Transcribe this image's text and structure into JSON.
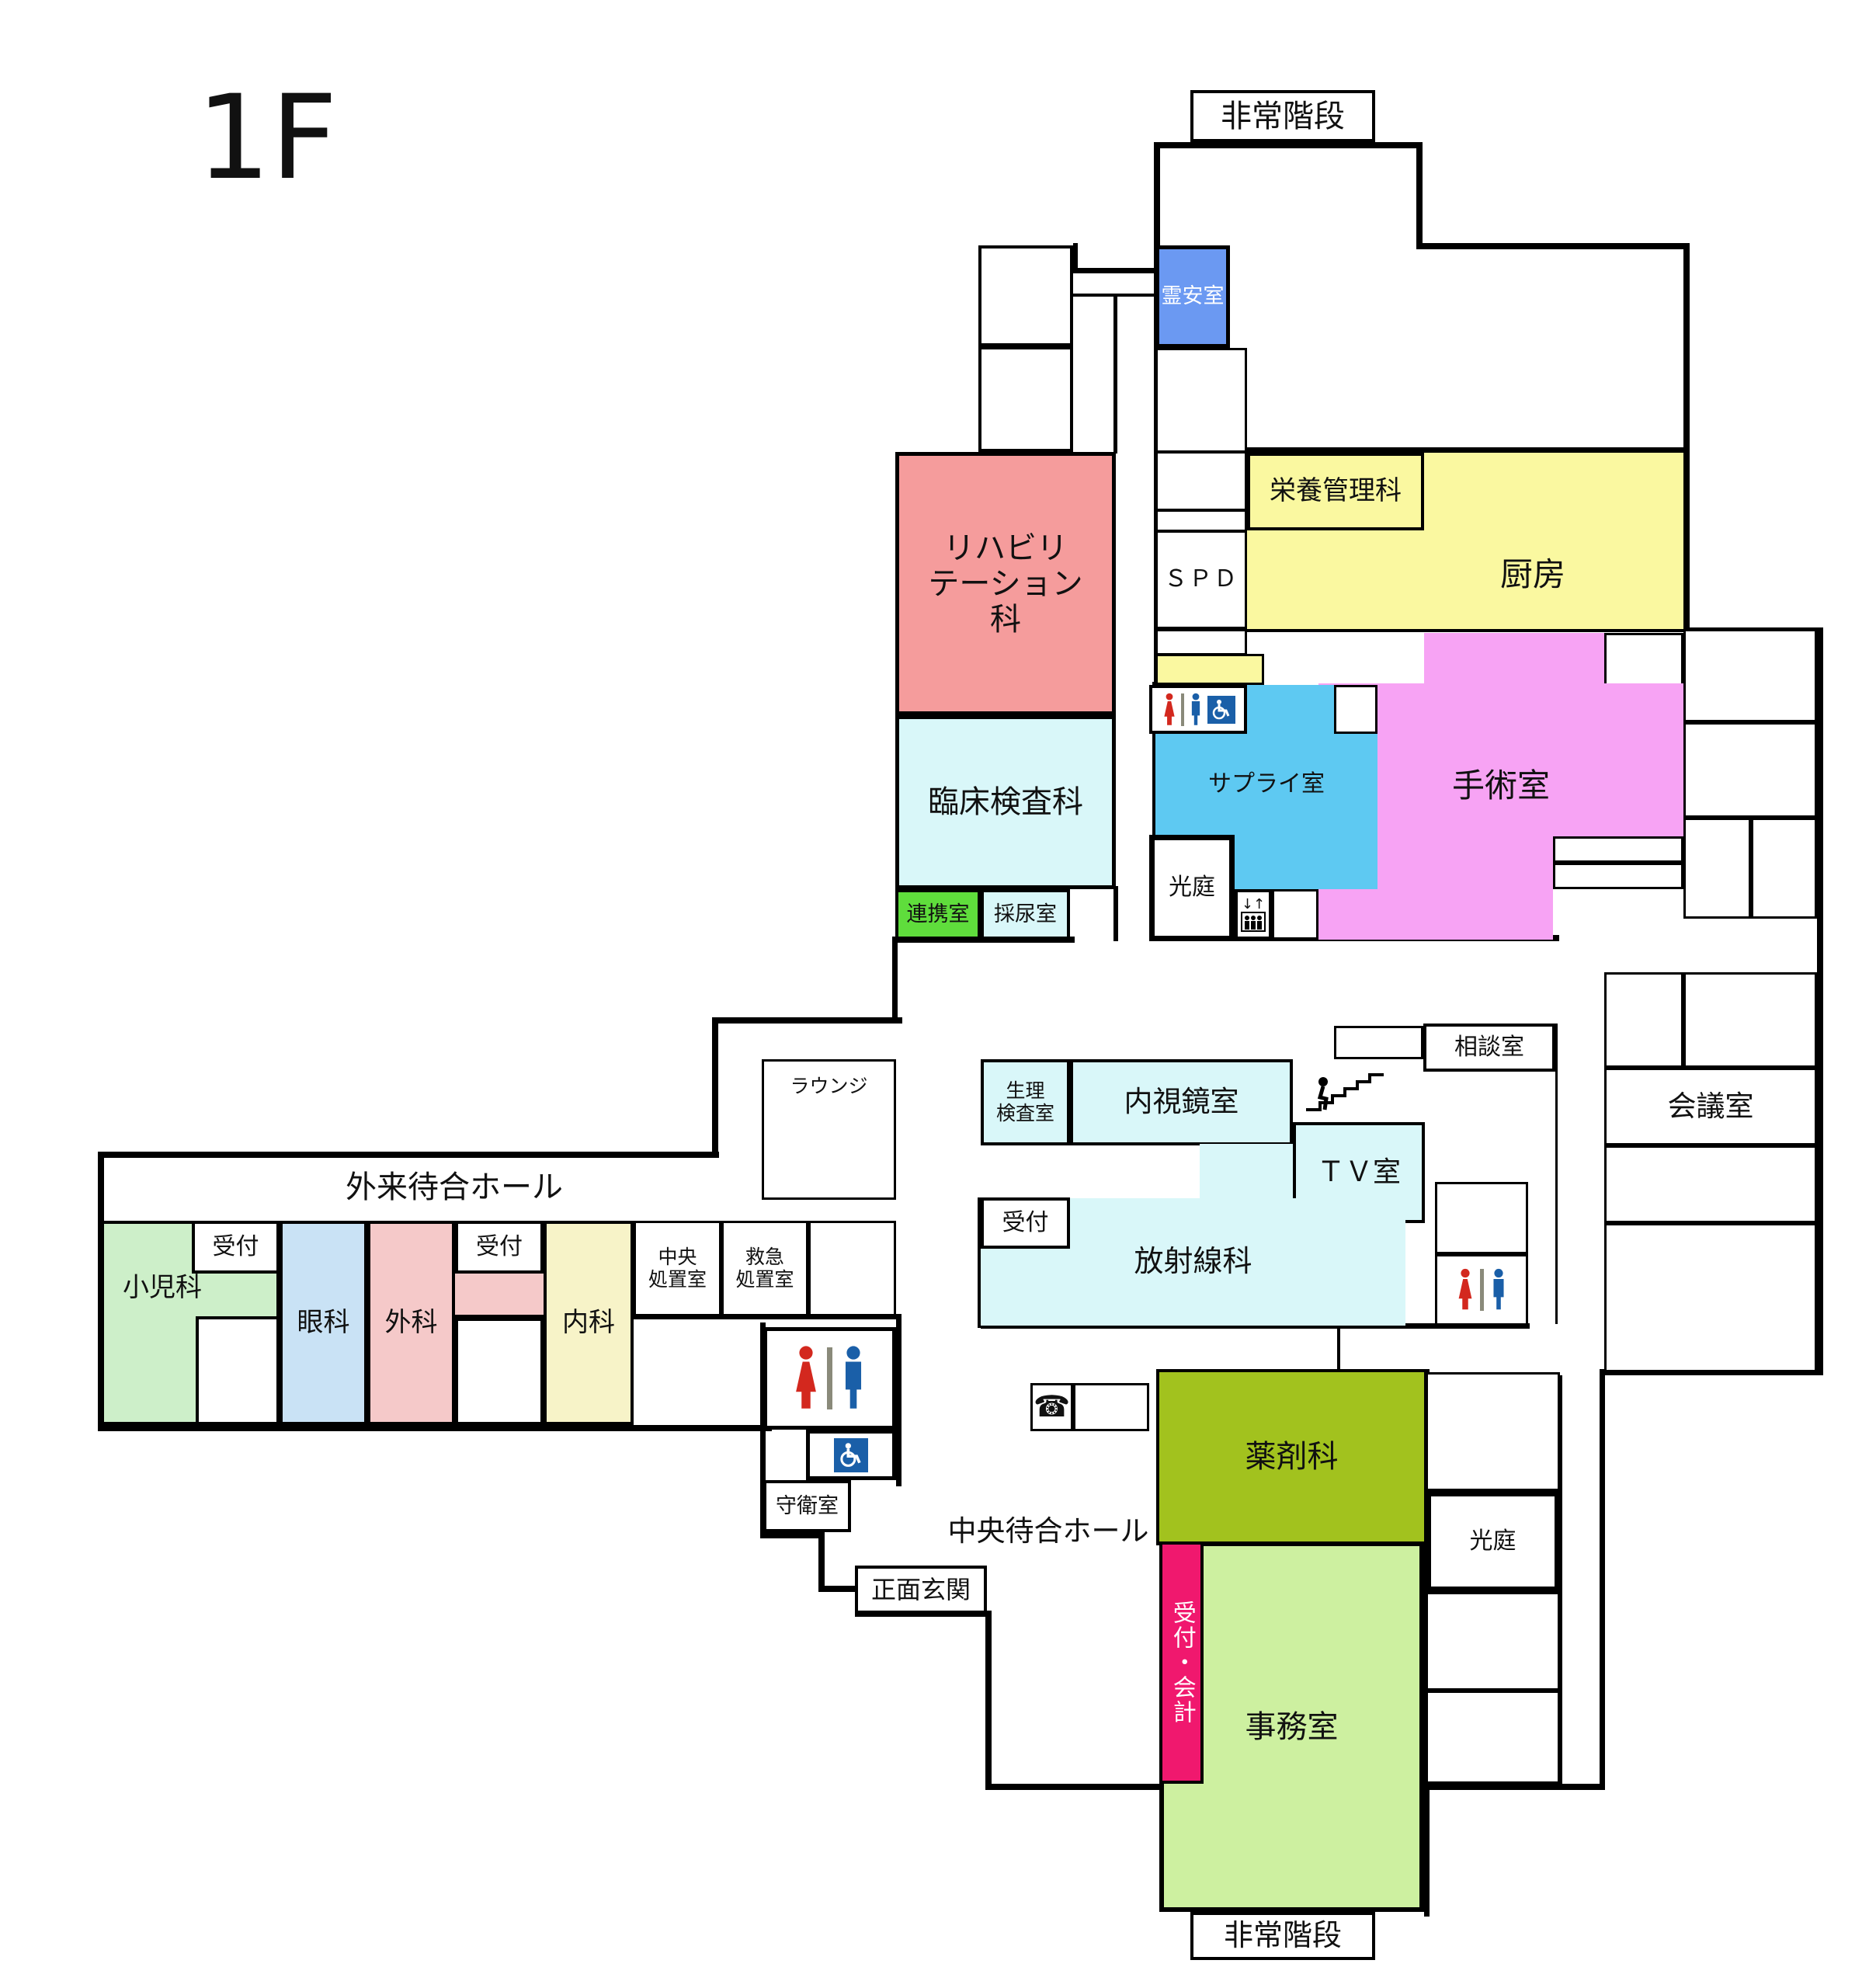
{
  "title": "1F",
  "rooms": {
    "hijokaidan": "非常階段",
    "reian": "霊安室",
    "rehab": "リハビリ\nテーション\n科",
    "rinsho": "臨床検査科",
    "renkei": "連携室",
    "sainyo": "採尿室",
    "eiyo": "栄養管理科",
    "spd": "ＳＰＤ",
    "chubo": "厨房",
    "supply": "サプライ室",
    "shujutsu": "手術室",
    "koutei": "光庭",
    "soudan": "相談室",
    "tv": "ＴＶ室",
    "naishikyo": "内視鏡室",
    "seiri": "生理\n検査室",
    "housha": "放射線科",
    "uketsuke": "受付",
    "kaigi": "会議室",
    "lounge": "ラウンジ",
    "gairai_hall": "外来待合ホール",
    "shonika": "小児科",
    "ganka": "眼科",
    "geka": "外科",
    "naika": "内科",
    "chuo_shochi": "中央\n処置室",
    "kyukyu_shochi": "救急\n処置室",
    "shuei": "守衛室",
    "shomen": "正面玄関",
    "chuo_hall": "中央待合ホール",
    "yakuzai": "薬剤科",
    "jimu": "事務室",
    "uketsuke_kaikei": "受付・会計"
  },
  "icons": {
    "woman_toilet": "woman-icon",
    "man_toilet": "man-icon",
    "wheelchair": "wheelchair-icon",
    "elevator": "elevator-icon",
    "stairs_person": "stairs-person-icon",
    "phone": "phone-icon",
    "phone_glyph": "☎",
    "elevator_arrows": "↓↑"
  },
  "colors": {
    "mortuary": "#6B99F2",
    "rehab": "#F59C9C",
    "lab_cyan": "#D9F7F9",
    "renkei_green": "#5FDD3C",
    "kitchen_yellow": "#FAF8A0",
    "supply_blue": "#5EC9F2",
    "operating_pink": "#F7A3F4",
    "pediatrics": "#CDEFC9",
    "ophthalmology": "#C9E2F5",
    "surgery_pink": "#F5C9C9",
    "internal_yellow": "#F7F3C8",
    "pharmacy_olive": "#A2C21E",
    "office_green": "#CDF0A0",
    "reception_crimson": "#F0186E",
    "icon_red": "#D3281E",
    "icon_blue": "#1A5FA8",
    "wall": "#000000"
  }
}
